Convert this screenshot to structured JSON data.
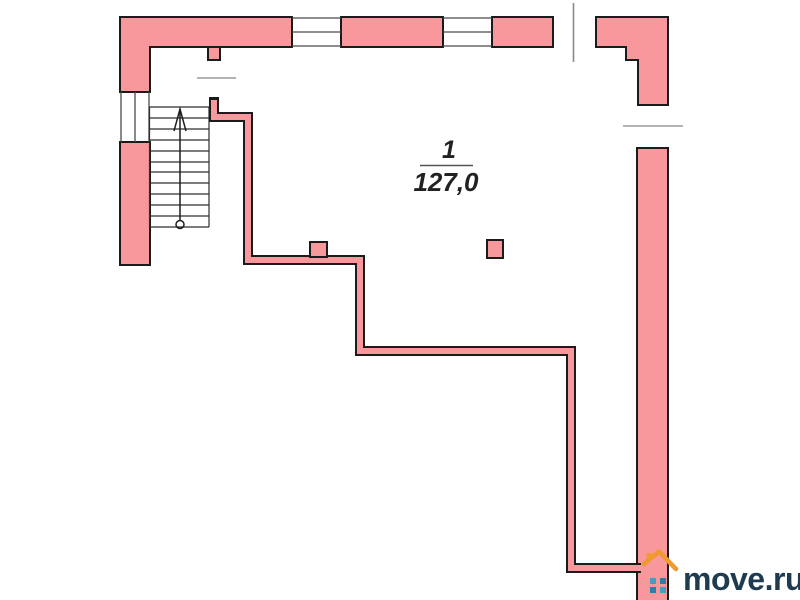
{
  "plan": {
    "room": {
      "number": "1",
      "area": "127,0"
    },
    "staircase": {
      "steps": 11,
      "direction": "up"
    }
  },
  "watermark": {
    "text": "move.ru"
  },
  "colors": {
    "wall_fill": "#f8989d",
    "wall_outline": "#1b1b1b",
    "detail_line": "#3a3a3a",
    "marker_line": "#9a9a9a",
    "label_text": "#222222",
    "logo_text": "#1e3b50",
    "logo_roof": "#f0992f",
    "logo_window_light": "#41a0c0",
    "logo_window_dark": "#2b7fa8"
  },
  "icons": {
    "staircase": "staircase-with-up-arrow",
    "logo_house": "house-icon"
  }
}
